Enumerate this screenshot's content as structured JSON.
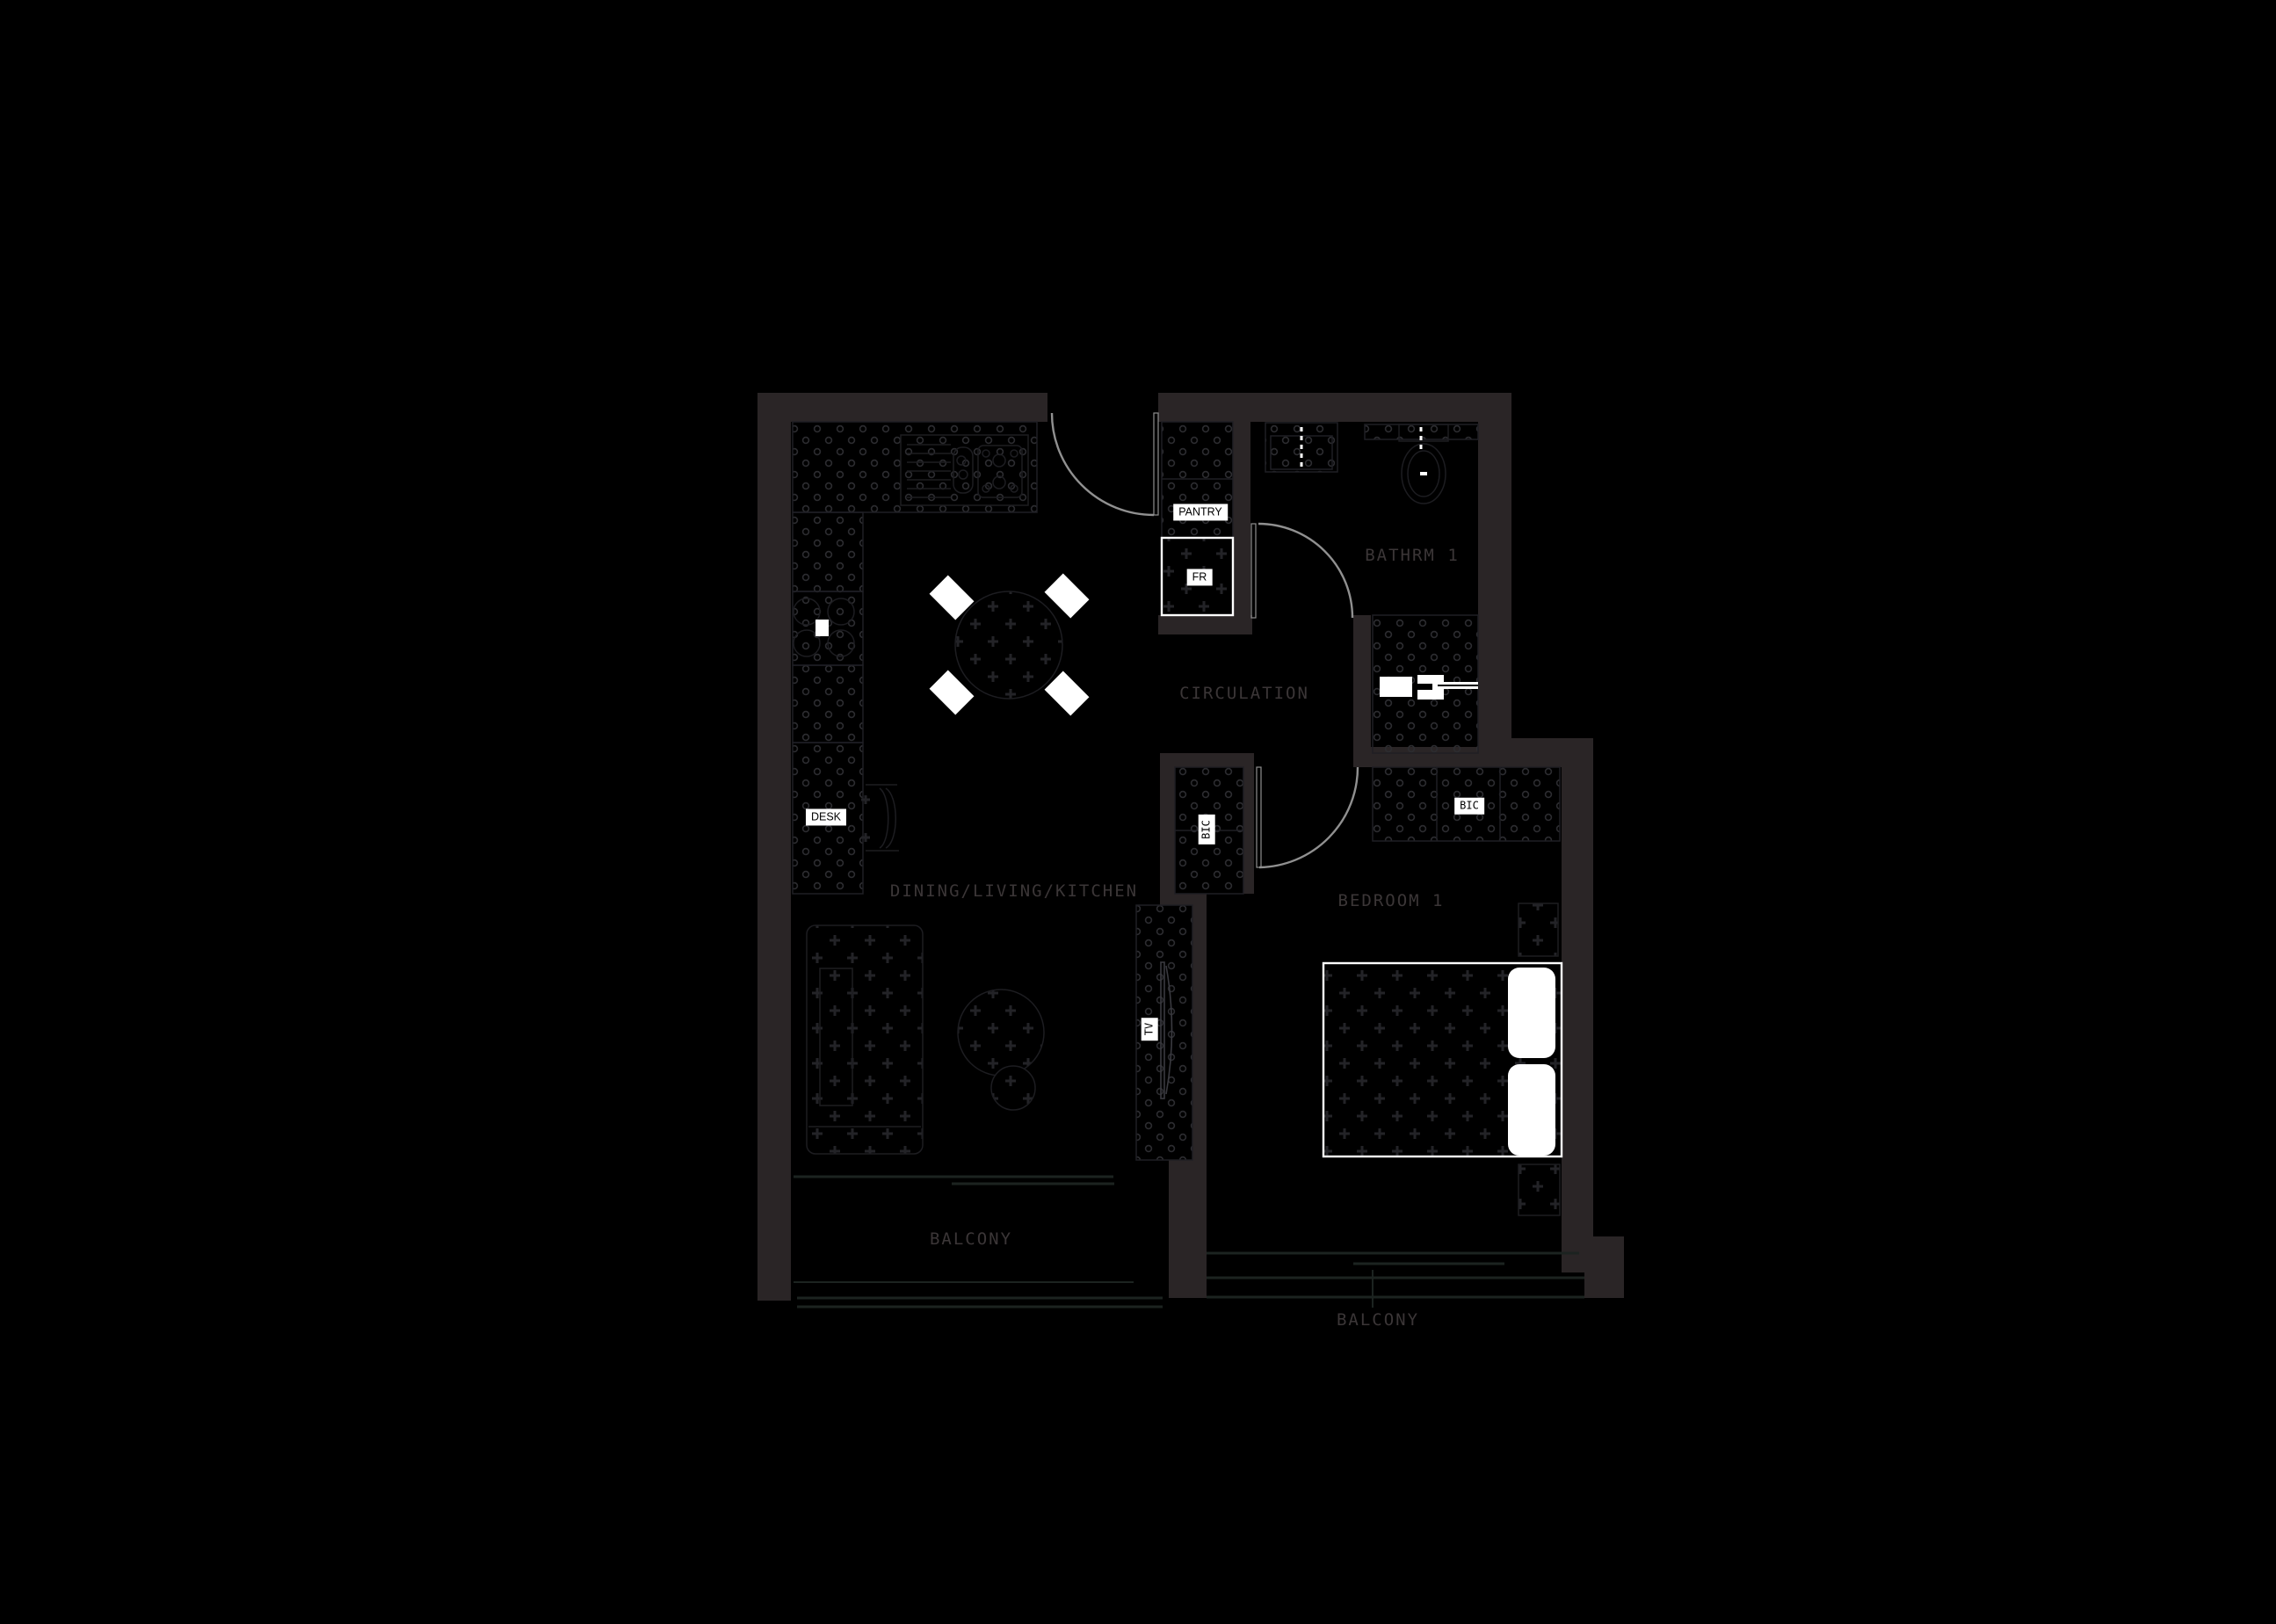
{
  "theme": {
    "background": "#000000",
    "wall": "#2a2526",
    "floor_line": "#1f1f24",
    "furniture_line": "#1d1d21",
    "texture_dot": "#2c2c30",
    "texture_plus": "#232327",
    "door_arc": "#909090",
    "room_label": "#3b3637",
    "glass_line": "#1c2320",
    "tag_bg": "#ffffff",
    "tag_text": "#000000",
    "fixture_white": "#ffffff"
  },
  "plan": {
    "rooms": [
      {
        "id": "dining-living-kitchen",
        "label": "DINING/LIVING/KITCHEN"
      },
      {
        "id": "circulation",
        "label": "CIRCULATION"
      },
      {
        "id": "bathrm-1",
        "label": "BATHRM 1"
      },
      {
        "id": "bedroom-1",
        "label": "BEDROOM 1"
      },
      {
        "id": "balcony-left",
        "label": "BALCONY"
      },
      {
        "id": "balcony-right",
        "label": "BALCONY"
      }
    ],
    "fixtures": [
      {
        "id": "pantry",
        "label": "PANTRY"
      },
      {
        "id": "fridge",
        "label": "FR"
      },
      {
        "id": "desk",
        "label": "DESK"
      },
      {
        "id": "bic-circulation",
        "label": "BIC"
      },
      {
        "id": "bic-bedroom",
        "label": "BIC"
      },
      {
        "id": "tv",
        "label": "TV"
      }
    ]
  }
}
